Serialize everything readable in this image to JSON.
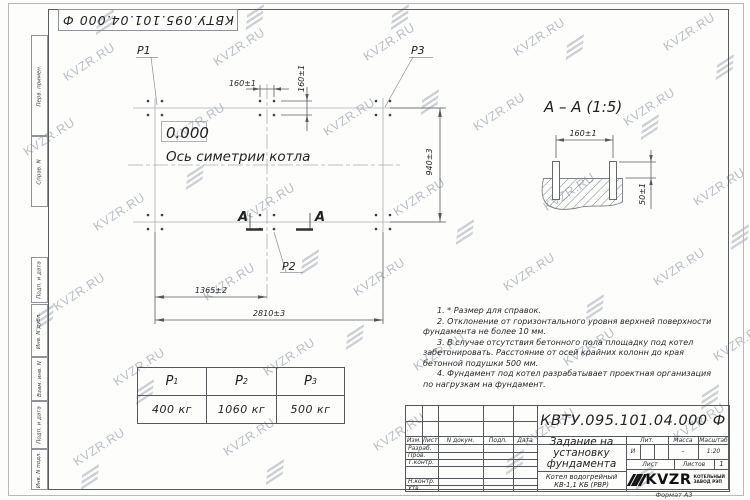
{
  "watermark": {
    "text": "KVZR.RU"
  },
  "stamp": {
    "code": "КВТУ.095.101.04.000  Ф"
  },
  "margin_labels": [
    "Перв. примен.",
    "Справ. N",
    "Подп. и дата",
    "Инв. N дубл.",
    "Взам. инв. N",
    "Подп. и дата",
    "Инв. N подл."
  ],
  "plan": {
    "labels": {
      "p1": "P1",
      "p2": "P2",
      "p3": "P3",
      "level": "0.000",
      "axis": "Ось симетрии котла",
      "section_letter_left": "А",
      "section_letter_right": "А"
    },
    "dims": {
      "bolt_spacing_h": "160±1",
      "bolt_spacing_v": "160±1",
      "width": "940±3",
      "left_to_center": "1365±2",
      "total_length": "2810±3"
    }
  },
  "section_view": {
    "title": "А – А  (1:5)",
    "dims": {
      "bolt_spacing": "160±1",
      "protrusion": "50±1"
    }
  },
  "notes": [
    "1.  * Размер для справок.",
    "2.  Отклонение от горизонтального уровня верхней поверхности фундамента не более 10 мм.",
    "3.  В случае отсутствия бетонного пола площадку под котел забетонировать. Расстояние от осей крайних колонн до края бетонной подушки 500 мм.",
    "4.  Фундамент под котел разрабатывает проектная организация по нагрузкам на фундамент."
  ],
  "load_table": {
    "columns": [
      {
        "symbol": "P",
        "sub": "1",
        "value": "400 кг"
      },
      {
        "symbol": "P",
        "sub": "2",
        "value": "1060 кг"
      },
      {
        "symbol": "P",
        "sub": "3",
        "value": "500 кг"
      }
    ]
  },
  "title_block": {
    "designation": "КВТУ.095.101.04.000  Ф",
    "title_lines": [
      "Задание на",
      "установку",
      "фундамента"
    ],
    "product_lines": [
      "Котел водогрейный",
      "КВ-1,1 КБ  (РВР)"
    ],
    "header_cols": {
      "izm": "Изм.",
      "list": "Лист",
      "ndok": "N докум.",
      "podp": "Подп.",
      "data": "Дата"
    },
    "role_rows": [
      "Разраб.",
      "Пров.",
      "Т.контр.",
      "Н.контр.",
      "Утв."
    ],
    "lit": {
      "label": "Лит.",
      "value": "И"
    },
    "mass": {
      "label": "Масса",
      "value": "–"
    },
    "scale": {
      "label": "Масштаб",
      "value": "1:20"
    },
    "sheet": {
      "label": "Лист"
    },
    "sheets": {
      "label": "Листов",
      "value": "1"
    },
    "logo": {
      "text": "KVZR",
      "caption_lines": [
        "КОТЕЛЬНЫЙ",
        "ЗАВОД РЭП"
      ]
    },
    "format": "Формат  А3"
  }
}
